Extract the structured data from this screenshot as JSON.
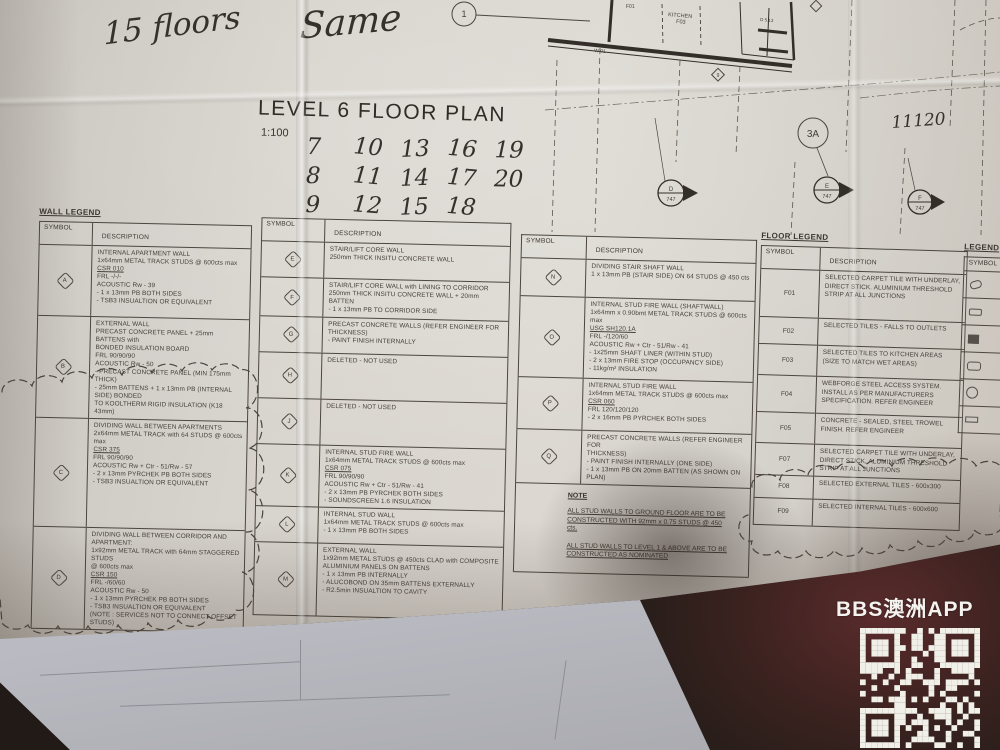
{
  "handwriting": {
    "floors_note": "15 floors",
    "same_note": "Same",
    "numbers_rows": [
      [
        "7",
        "10",
        "13",
        "16",
        "19"
      ],
      [
        "8",
        "11",
        "14",
        "17",
        "20"
      ],
      [
        "9",
        "12",
        "15",
        "18"
      ]
    ],
    "dimension": "11120"
  },
  "title_block": {
    "title": "LEVEL 6 FLOOR PLAN",
    "scale": "1:100"
  },
  "plan_fragment": {
    "grid_bubble_top": "1",
    "grid_bubble": "3A",
    "kitchen_label": "KITCHEN",
    "kitchen_code": "F03",
    "floor_code": "F01",
    "wall_tag": "W 01",
    "door_tag": "D 5.13",
    "marker_9": "9",
    "section_markers": [
      {
        "letter": "D",
        "number": "747"
      },
      {
        "letter": "E",
        "number": "747"
      },
      {
        "letter": "F",
        "number": "747"
      }
    ]
  },
  "wall_legend": {
    "title": "WALL LEGEND",
    "headers": [
      "SYMBOL",
      "DESCRIPTION"
    ],
    "rows": [
      {
        "symbol": "A",
        "lines": [
          {
            "text": "INTERNAL APARTMENT WALL"
          },
          {
            "text": "1x64mm METAL TRACK STUDS @ 600cts max"
          },
          {
            "text": "CSR 010",
            "u": true
          },
          {
            "text": "FRL -/-/-"
          },
          {
            "text": "ACOUSTIC Rw - 39"
          },
          {
            "text": "- 1 x 13mm PB BOTH SIDES"
          },
          {
            "text": "- TSB3 INSUALTION OR EQUIVALENT"
          }
        ]
      },
      {
        "symbol": "B",
        "lines": [
          {
            "text": "EXTERNAL WALL"
          },
          {
            "text": "PRECAST CONCRETE PANEL + 25mm BATTENS with"
          },
          {
            "text": "BONDED INSULATION BOARD"
          },
          {
            "text": "FRL 90/90/90"
          },
          {
            "text": "ACOUSTIC Rw - 50"
          },
          {
            "text": "- PRECAST CONCRETE PANEL (MIN 175mm THICK)"
          },
          {
            "text": "- 25mm BATTENS + 1 x 13mm PB (INTERNAL SIDE) BONDED"
          },
          {
            "text": "TO KOOLTHERM RIGID INSULATION (K18 43mm)"
          }
        ]
      },
      {
        "symbol": "C",
        "lines": [
          {
            "text": "DIVIDING WALL BETWEEN APARTMENTS"
          },
          {
            "text": "2x64mm METAL TRACK with 64 STUDS @ 600cts max"
          },
          {
            "text": "CSR 375",
            "u": true
          },
          {
            "text": "FRL 90/90/90"
          },
          {
            "text": "ACOUSTIC Rw + Ctr - 51/Rw - 57"
          },
          {
            "text": "- 2 x 13mm PYRCHEK PB BOTH SIDES"
          },
          {
            "text": "- TSB3 INSUALTION OR EQUIVALENT"
          }
        ]
      },
      {
        "symbol": "D",
        "lines": [
          {
            "text": "DIVIDING WALL BETWEEN CORRIDOR AND APARTMENT:"
          },
          {
            "text": "1x92mm METAL TRACK with 64mm STAGGERED STUDS"
          },
          {
            "text": "@ 600cts max"
          },
          {
            "text": "CSR 150",
            "u": true
          },
          {
            "text": "FRL -/60/60"
          },
          {
            "text": "ACOUSTIC Rw - 50"
          },
          {
            "text": "- 1 x 13mm PYRCHEK PB BOTH SIDES"
          },
          {
            "text": "- TSB3 INSUALTION OR EQUIVALENT"
          },
          {
            "text": "(NOTE : SERVICES NOT TO CONNECT OFFSET STUDS)"
          }
        ]
      }
    ]
  },
  "wall_legend_2": {
    "headers": [
      "SYMBOL",
      "DESCRIPTION"
    ],
    "rows": [
      {
        "symbol": "E",
        "lines": [
          {
            "text": "STAIR/LIFT CORE WALL"
          },
          {
            "text": "250mm THICK INSITU CONCRETE WALL"
          }
        ]
      },
      {
        "symbol": "F",
        "lines": [
          {
            "text": "STAIR/LIFT CORE WALL with LINING TO CORRIDOR"
          },
          {
            "text": "250mm THICK INSITU CONCRETE WALL + 20mm BATTEN"
          },
          {
            "text": "- 1 x 13mm PB TO CORRIDOR SIDE"
          }
        ]
      },
      {
        "symbol": "G",
        "lines": [
          {
            "text": "PRECAST CONCRETE WALLS (REFER ENGINEER FOR"
          },
          {
            "text": "THICKNESS)"
          },
          {
            "text": "- PAINT FINISH INTERNALLY"
          }
        ]
      },
      {
        "symbol": "H",
        "lines": [
          {
            "text": "DELETED - NOT USED"
          }
        ]
      },
      {
        "symbol": "J",
        "lines": [
          {
            "text": "DELETED - NOT USED"
          }
        ]
      },
      {
        "symbol": "K",
        "lines": [
          {
            "text": "INTERNAL STUD FIRE WALL"
          },
          {
            "text": "1x64mm METAL TRACK STUDS @ 600cts max"
          },
          {
            "text": "CSR 075",
            "u": true
          },
          {
            "text": "FRL 90/90/90"
          },
          {
            "text": "ACOUSTIC Rw + Ctr - 51/Rw - 41"
          },
          {
            "text": "- 2 x 13mm PB PYRCHEK BOTH SIDES"
          },
          {
            "text": "- SOUNDSCREEN 1.6 INSULATION"
          }
        ]
      },
      {
        "symbol": "L",
        "lines": [
          {
            "text": "INTERNAL STUD WALL"
          },
          {
            "text": "1x64mm METAL TRACK STUDS @ 600cts max"
          },
          {
            "text": "- 1 x 13mm PB BOTH SIDES"
          }
        ]
      },
      {
        "symbol": "M",
        "lines": [
          {
            "text": "EXTERNAL WALL"
          },
          {
            "text": "1x92mm METAL STUDS @ 450cts CLAD with COMPOSITE"
          },
          {
            "text": "ALUMINIUM PANELS ON BATTENS"
          },
          {
            "text": "- 1 x 13mm PB INTERNALLY"
          },
          {
            "text": "- ALUCOBOND ON 35mm BATTENS EXTERNALLY"
          },
          {
            "text": "- R2.5min INSUALTION TO CAVITY"
          }
        ]
      }
    ]
  },
  "wall_legend_3": {
    "headers": [
      "SYMBOL",
      "DESCRIPTION"
    ],
    "rows": [
      {
        "symbol": "N",
        "lines": [
          {
            "text": "DIVIDING STAIR SHAFT WALL"
          },
          {
            "text": "1 x 13mm PB (STAIR SIDE) ON 64 STUDS @ 450 cts"
          }
        ]
      },
      {
        "symbol": "O",
        "lines": [
          {
            "text": "INTERNAL STUD FIRE WALL (SHAFTWALL)"
          },
          {
            "text": "1x64mm x 0.90bmt METAL TRACK STUDS @ 600cts max"
          },
          {
            "text": "USG SH120.1A",
            "u": true
          },
          {
            "text": "FRL -/120/60"
          },
          {
            "text": "ACOUSTIC Rw + Ctr - 51/Rw - 41"
          },
          {
            "text": "- 1x25mm SHAFT LINER (WITHIN STUD)"
          },
          {
            "text": "- 2 x 13mm FIRE STOP (OCCUPANCY SIDE)"
          },
          {
            "text": "- 11kg/m² INSULATION"
          }
        ]
      },
      {
        "symbol": "P",
        "lines": [
          {
            "text": "INTERNAL STUD FIRE WALL"
          },
          {
            "text": "1x64mm METAL TRACK STUDS @ 600cts max"
          },
          {
            "text": "CSR 060",
            "u": true
          },
          {
            "text": "FRL 120/120/120"
          },
          {
            "text": "- 2 x 16mm PB PYRCHEK BOTH SIDES"
          }
        ]
      },
      {
        "symbol": "Q",
        "lines": [
          {
            "text": "PRECAST CONCRETE WALLS (REFER ENGINEER FOR"
          },
          {
            "text": "THICKNESS)"
          },
          {
            "text": "- PAINT FINISH INTERNALLY (ONE SIDE)"
          },
          {
            "text": "- 1 x 13mm PB ON 20mm BATTEN (AS SHOWN ON PLAN)"
          }
        ]
      }
    ],
    "note": {
      "title": "NOTE",
      "paragraph_1": "ALL STUD WALLS TO GROUND FLOOR ARE TO BE CONSTRUCTED WITH 92mm x 0.75 STUDS @ 450 cts.",
      "paragraph_2": "ALL STUD WALLS TO LEVEL 1 & ABOVE ARE TO BE CONSTRUCTED AS NOMINATED"
    }
  },
  "floor_legend": {
    "title": "FLOOR LEGEND",
    "headers": [
      "SYMBOL",
      "DESCRIPTION"
    ],
    "rows": [
      {
        "symbol": "F01",
        "desc": "SELECTED CARPET TILE WITH UNDERLAY, DIRECT STICK. ALUMINIUM THRESHOLD STRIP AT ALL JUNCTIONS"
      },
      {
        "symbol": "F02",
        "desc": "SELECTED TILES - FALLS TO OUTLETS"
      },
      {
        "symbol": "F03",
        "desc": "SELECTED TILES TO KITCHEN AREAS (SIZE TO MATCH WET AREAS)"
      },
      {
        "symbol": "F04",
        "desc": "WEBFORGE STEEL ACCESS SYSTEM. INSTALL AS PER MANUFACTURERS SPECIFICATION. REFER ENGINEER"
      },
      {
        "symbol": "F05",
        "desc": "CONCRETE - SEALED, STEEL TROWEL FINISH. REFER ENGINEER"
      },
      {
        "symbol": "F07",
        "desc": "SELECTED CARPET TILE WITH UNDERLAY, DIRECT STICK, ALUMINIUM THRESHOLD STRIP AT ALL JUNCTIONS"
      },
      {
        "symbol": "F08",
        "desc": "SELECTED EXTERNAL TILES - 600x300"
      },
      {
        "symbol": "F09",
        "desc": "SELECTED INTERNAL TILES - 600x600"
      }
    ]
  },
  "side_legend": {
    "title": "LEGEND",
    "header": "SYMBOL"
  },
  "watermark": {
    "brand": "BBS澳洲APP"
  },
  "colors": {
    "paper": "#d5d1ca",
    "ink": "#46413a",
    "background": "#241d19",
    "watermark": "#f4f3ef"
  }
}
